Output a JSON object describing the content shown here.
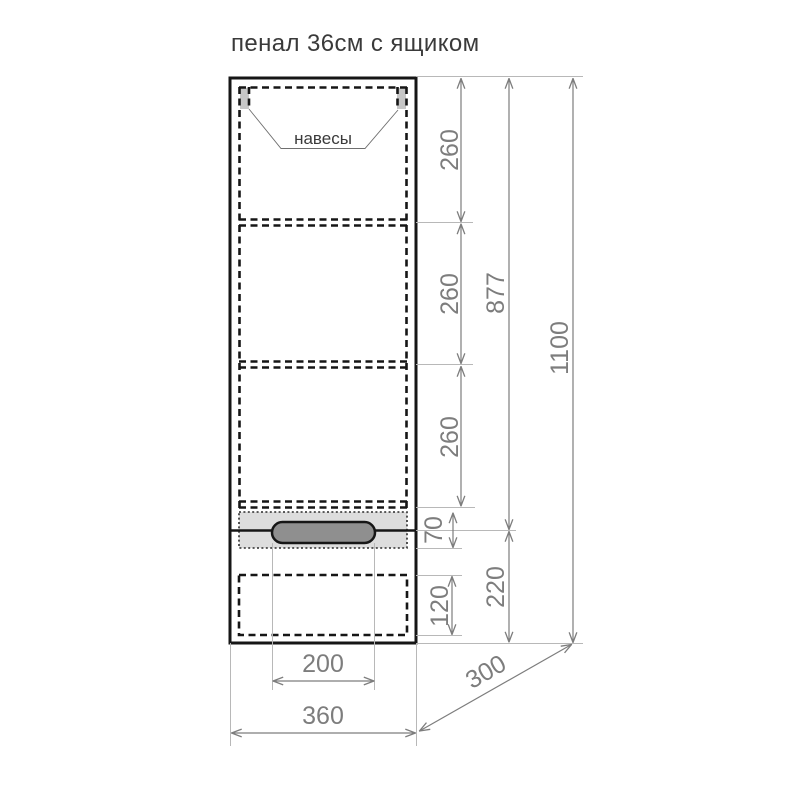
{
  "title": "пенал 36см с ящиком",
  "labels": {
    "hinges": "навесы"
  },
  "dimensions": {
    "shelf_sections": [
      "260",
      "260",
      "260"
    ],
    "handle_zone": "70",
    "drawer_inner_height": "120",
    "upper_body_height": "877",
    "drawer_front_height": "220",
    "total_height": "1100",
    "handle_width": "200",
    "cabinet_width": "360",
    "cabinet_depth": "300"
  },
  "colors": {
    "outline": "#161616",
    "dimension": "#7d7d7d",
    "extension": "#b8b8b8",
    "hinge_fill": "#c6c6c6",
    "band_fill": "#dddddd",
    "handle_fill": "#8f8f8f",
    "title_text": "#3a3a3a"
  }
}
